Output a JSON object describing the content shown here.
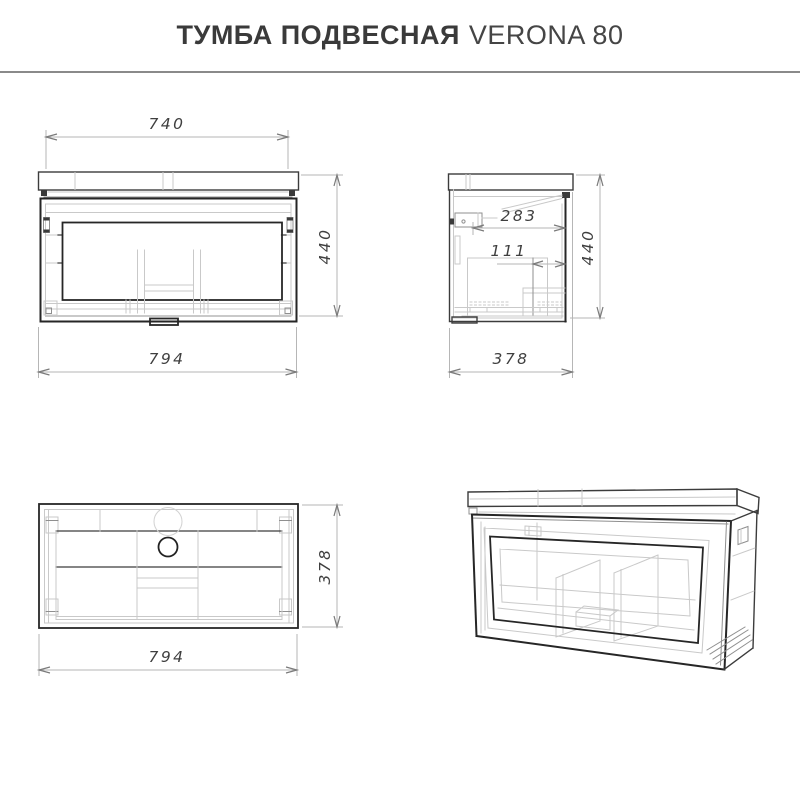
{
  "header": {
    "title_bold": "ТУМБА ПОДВЕСНАЯ",
    "title_regular": "VERONA 80"
  },
  "drawing": {
    "views": {
      "front": {
        "name": "front orthographic view",
        "dims": {
          "top_width": "740",
          "height": "440",
          "overall_width": "794"
        }
      },
      "side": {
        "name": "side orthographic view",
        "dims": {
          "inner_depth": "283",
          "drawer_offset": "111",
          "height": "440",
          "overall_depth": "378"
        }
      },
      "top": {
        "name": "top orthographic view",
        "dims": {
          "overall_depth": "378",
          "overall_width": "794"
        }
      },
      "perspective": {
        "name": "3d wireframe view"
      }
    }
  },
  "colors": {
    "background": "#ffffff",
    "line_dark": "#262626",
    "line_mid": "#8f8f8f",
    "line_light": "#c9c9c9",
    "dim_line": "#b6b6b6",
    "dim_text": "#3f3f3f",
    "divider": "#8a8a8a"
  }
}
